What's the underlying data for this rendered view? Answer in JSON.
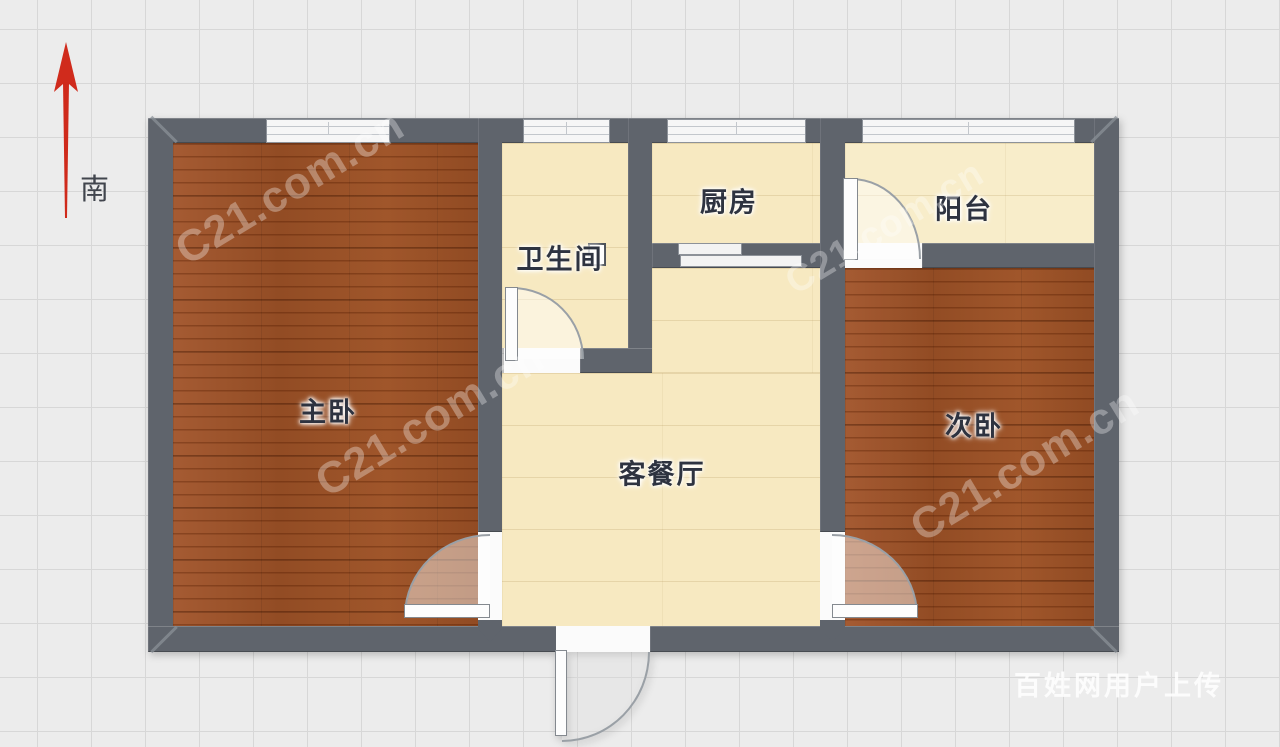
{
  "compass": {
    "label": "南"
  },
  "rooms": {
    "master": {
      "label": "主卧"
    },
    "bathroom": {
      "label": "卫生间"
    },
    "kitchen": {
      "label": "厨房"
    },
    "balcony": {
      "label": "阳台"
    },
    "living": {
      "label": "客餐厅"
    },
    "second": {
      "label": "次卧"
    }
  },
  "watermarks": {
    "brand": "C21.com.cn",
    "uploader": "百姓网用户上传"
  },
  "colors": {
    "wall": "#5f646c",
    "wood_floor": "#9a4e21",
    "cream_floor": "#f7e9c1",
    "arrow_red": "#d02b1c",
    "background": "#ececec"
  }
}
